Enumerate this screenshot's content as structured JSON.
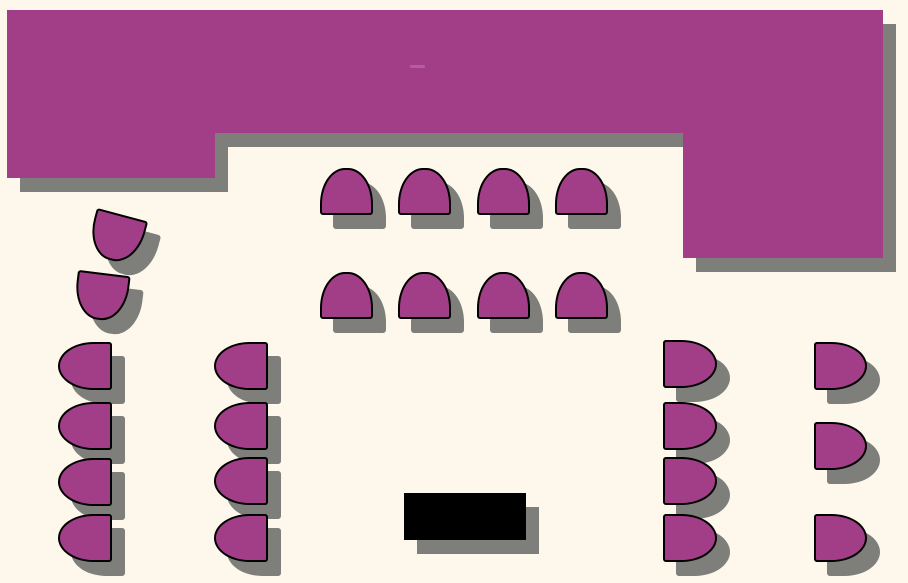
{
  "plan": {
    "description": "banquet-room-seating-floor-plan",
    "canvas": {
      "width": 908,
      "height": 583
    },
    "total_chairs": 25
  },
  "palette": {
    "background": "#FDF8EB",
    "furniture_fill": "#A23E88",
    "chair_outline": "#000000",
    "shadow": "#7E7E7A",
    "podium_fill": "#000000",
    "artifact_mark": "#C279AC"
  },
  "shadow_offset": {
    "x": 13,
    "y": 14
  },
  "head_table": {
    "blocks": [
      {
        "id": "head-table-block-left",
        "x": 7,
        "y": 10,
        "w": 208,
        "h": 168
      },
      {
        "id": "head-table-block-middle",
        "x": 215,
        "y": 10,
        "w": 468,
        "h": 123
      },
      {
        "id": "head-table-block-right",
        "x": 683,
        "y": 10,
        "w": 200,
        "h": 248
      }
    ]
  },
  "chairs": [
    {
      "id": "chair-head-end-1",
      "x": 90,
      "y": 214,
      "w": 53,
      "h": 47,
      "facing": "up",
      "rotate": 195
    },
    {
      "id": "chair-head-end-2",
      "x": 75,
      "y": 273,
      "w": 53,
      "h": 47,
      "facing": "up",
      "rotate": 187
    },
    {
      "id": "chair-center-r1-c1",
      "x": 320,
      "y": 168,
      "w": 53,
      "h": 47,
      "facing": "up",
      "rotate": 0
    },
    {
      "id": "chair-center-r1-c2",
      "x": 398,
      "y": 168,
      "w": 53,
      "h": 47,
      "facing": "up",
      "rotate": 0
    },
    {
      "id": "chair-center-r1-c3",
      "x": 477,
      "y": 168,
      "w": 53,
      "h": 47,
      "facing": "up",
      "rotate": 0
    },
    {
      "id": "chair-center-r1-c4",
      "x": 555,
      "y": 168,
      "w": 53,
      "h": 47,
      "facing": "up",
      "rotate": 0
    },
    {
      "id": "chair-center-r2-c1",
      "x": 320,
      "y": 272,
      "w": 53,
      "h": 47,
      "facing": "up",
      "rotate": 0
    },
    {
      "id": "chair-center-r2-c2",
      "x": 398,
      "y": 272,
      "w": 53,
      "h": 47,
      "facing": "up",
      "rotate": 0
    },
    {
      "id": "chair-center-r2-c3",
      "x": 477,
      "y": 272,
      "w": 53,
      "h": 47,
      "facing": "up",
      "rotate": 0
    },
    {
      "id": "chair-center-r2-c4",
      "x": 555,
      "y": 272,
      "w": 53,
      "h": 47,
      "facing": "up",
      "rotate": 0
    },
    {
      "id": "chair-left-col1-1",
      "x": 58,
      "y": 342,
      "w": 54,
      "h": 48,
      "facing": "left",
      "rotate": 0
    },
    {
      "id": "chair-left-col1-2",
      "x": 58,
      "y": 402,
      "w": 54,
      "h": 48,
      "facing": "left",
      "rotate": 0
    },
    {
      "id": "chair-left-col1-3",
      "x": 58,
      "y": 458,
      "w": 54,
      "h": 48,
      "facing": "left",
      "rotate": 0
    },
    {
      "id": "chair-left-col1-4",
      "x": 58,
      "y": 514,
      "w": 54,
      "h": 48,
      "facing": "left",
      "rotate": 0
    },
    {
      "id": "chair-left-col2-1",
      "x": 214,
      "y": 342,
      "w": 54,
      "h": 48,
      "facing": "left",
      "rotate": 0
    },
    {
      "id": "chair-left-col2-2",
      "x": 214,
      "y": 402,
      "w": 54,
      "h": 48,
      "facing": "left",
      "rotate": 0
    },
    {
      "id": "chair-left-col2-3",
      "x": 214,
      "y": 457,
      "w": 54,
      "h": 48,
      "facing": "left",
      "rotate": 0
    },
    {
      "id": "chair-left-col2-4",
      "x": 214,
      "y": 514,
      "w": 54,
      "h": 48,
      "facing": "left",
      "rotate": 0
    },
    {
      "id": "chair-right-col1-1",
      "x": 663,
      "y": 340,
      "w": 54,
      "h": 48,
      "facing": "right",
      "rotate": 0
    },
    {
      "id": "chair-right-col1-2",
      "x": 663,
      "y": 402,
      "w": 54,
      "h": 48,
      "facing": "right",
      "rotate": 0
    },
    {
      "id": "chair-right-col1-3",
      "x": 663,
      "y": 457,
      "w": 54,
      "h": 48,
      "facing": "right",
      "rotate": 0
    },
    {
      "id": "chair-right-col1-4",
      "x": 663,
      "y": 514,
      "w": 54,
      "h": 48,
      "facing": "right",
      "rotate": 0
    },
    {
      "id": "chair-right-col2-1",
      "x": 814,
      "y": 342,
      "w": 53,
      "h": 48,
      "facing": "right",
      "rotate": 0
    },
    {
      "id": "chair-right-col2-2",
      "x": 814,
      "y": 422,
      "w": 53,
      "h": 48,
      "facing": "right",
      "rotate": 0
    },
    {
      "id": "chair-right-col2-3",
      "x": 814,
      "y": 514,
      "w": 53,
      "h": 48,
      "facing": "right",
      "rotate": 0
    }
  ],
  "podium": {
    "id": "podium-table",
    "x": 404,
    "y": 493,
    "w": 122,
    "h": 47
  },
  "marks": [
    {
      "id": "paint-artifact",
      "x": 410,
      "y": 65,
      "w": 15,
      "h": 3
    }
  ]
}
